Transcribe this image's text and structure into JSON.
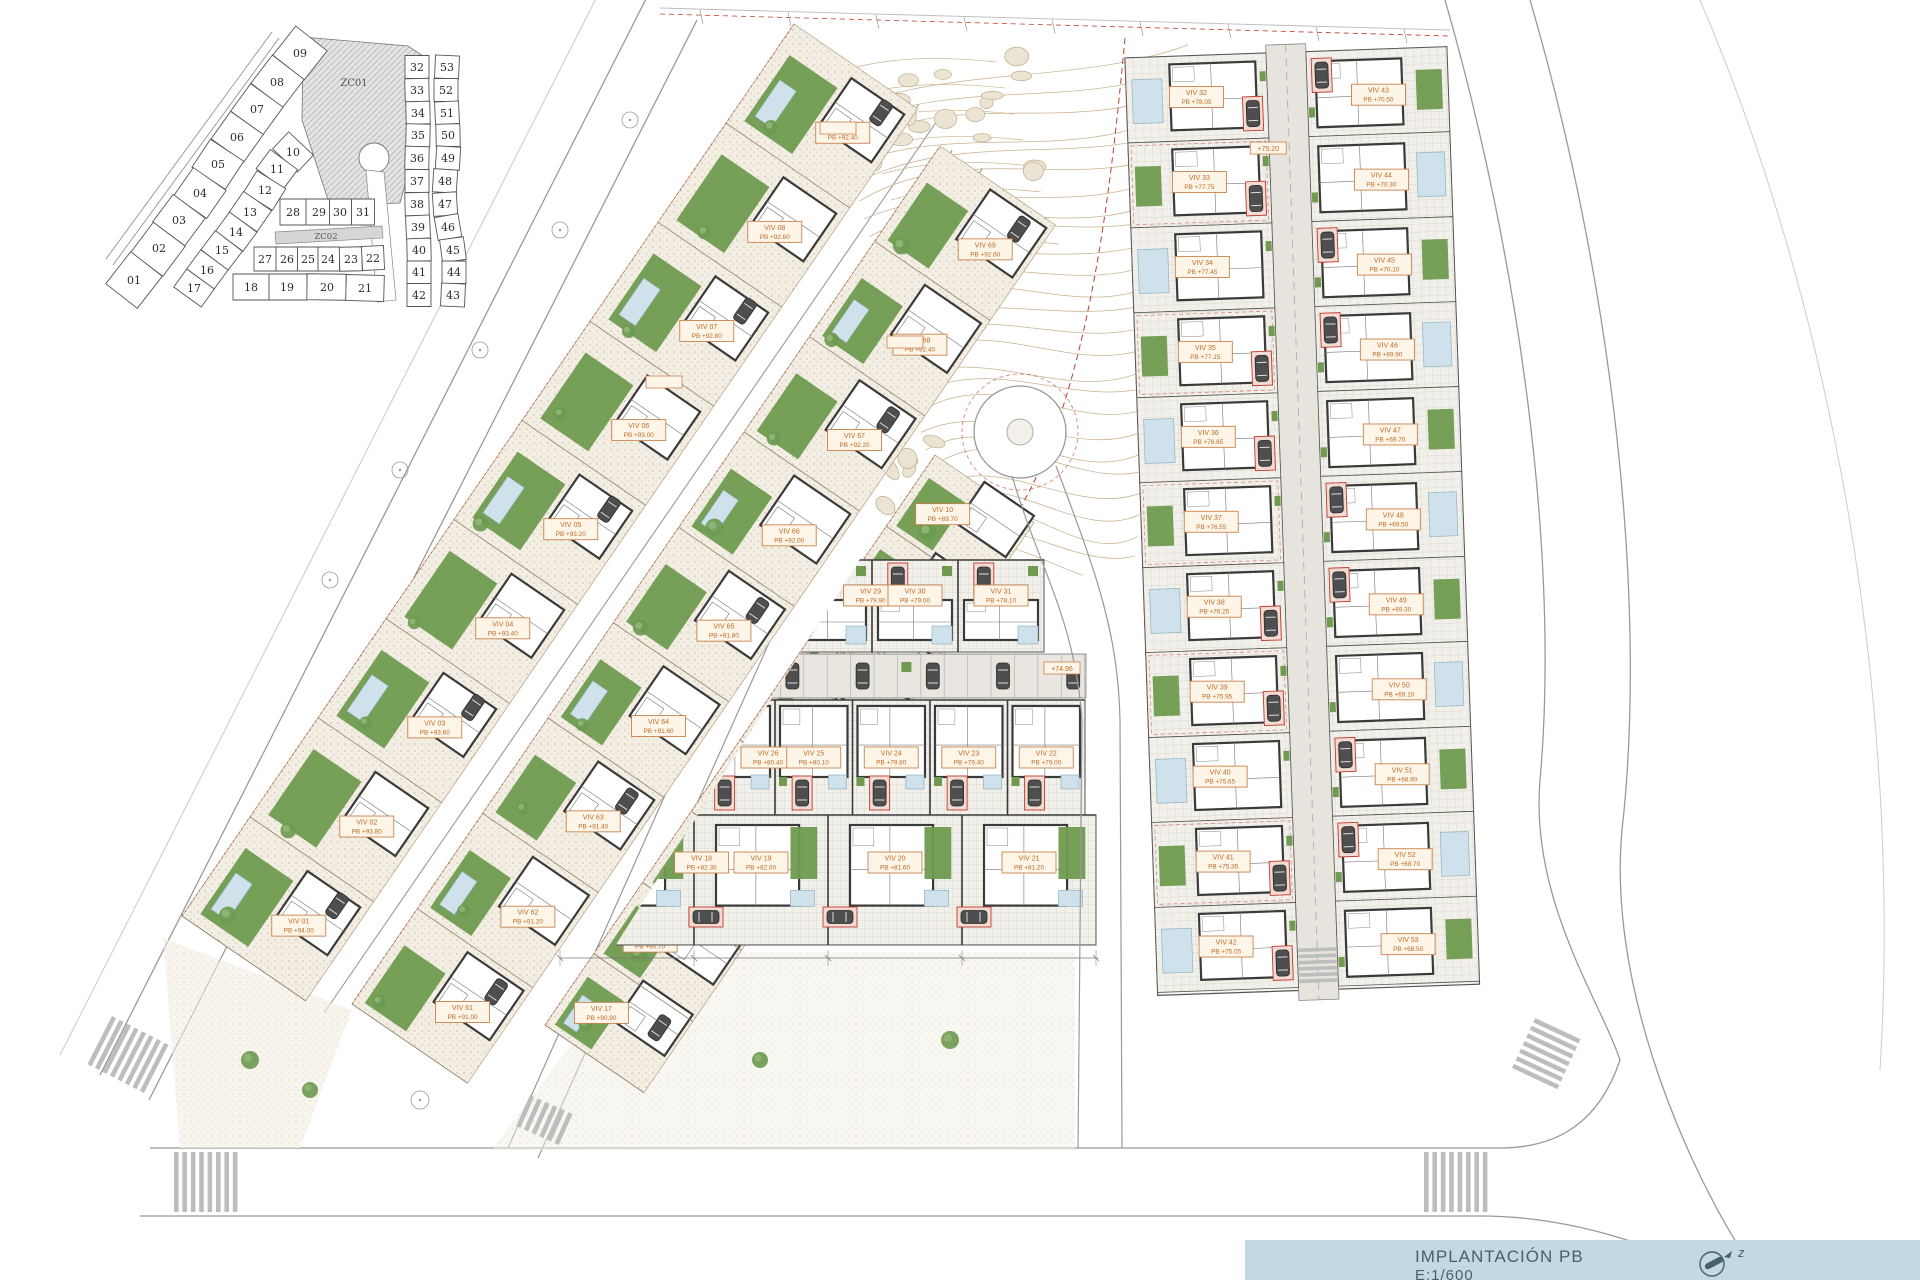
{
  "title_block": {
    "title": "IMPLANTACIÓN PB",
    "scale": "E:1/600",
    "north_label": "z"
  },
  "colors": {
    "label_text": "#c06a28",
    "label_bg": "#fdf5e7",
    "label_border": "#c8834f",
    "wall": "#3a3a3a",
    "garden": "#6f9a4f",
    "pool": "#cfe1ea",
    "contour": "#c8b28c",
    "road": "#999999",
    "red": "#c0392b",
    "title_bg": "#c3d8e0",
    "title_text": "#44616e"
  },
  "keyplan": {
    "zone1": "ZC01",
    "zone2": "ZC02",
    "strip_a": [
      "09",
      "08",
      "07",
      "06",
      "05",
      "04",
      "03",
      "02",
      "01"
    ],
    "strip_inner": [
      "10",
      "11",
      "12",
      "13",
      "14",
      "15",
      "16",
      "17"
    ],
    "row_top": [
      "28",
      "29",
      "30",
      "31"
    ],
    "row_mid": [
      "27",
      "26",
      "25",
      "24",
      "23",
      "22"
    ],
    "row_bottom": [
      "18",
      "19",
      "20",
      "21"
    ],
    "right_left_col": [
      "32",
      "33",
      "34",
      "35",
      "36",
      "37",
      "38",
      "39",
      "40",
      "41",
      "42"
    ],
    "right_right_col": [
      "53",
      "52",
      "51",
      "50",
      "49",
      "48",
      "47",
      "46",
      "45",
      "44",
      "43"
    ]
  },
  "site": {
    "strip_a_villas": [
      {
        "name": "VIV 01",
        "elev": "PB +94.00"
      },
      {
        "name": "VIV 02",
        "elev": "PB +93.80"
      },
      {
        "name": "VIV 03",
        "elev": "PB +93.60"
      },
      {
        "name": "VIV 04",
        "elev": "PB +93.40"
      },
      {
        "name": "VIV 05",
        "elev": "PB +93.20"
      },
      {
        "name": "VIV 06",
        "elev": "PB +93.00"
      },
      {
        "name": "VIV 07",
        "elev": "PB +92.80"
      },
      {
        "name": "VIV 08",
        "elev": "PB +92.60"
      },
      {
        "name": "VIV 09",
        "elev": "PB +92.40"
      }
    ],
    "strip_b_villas": [
      {
        "name": "VIV 61",
        "elev": "PB +91.00"
      },
      {
        "name": "VIV 62",
        "elev": "PB +91.20"
      },
      {
        "name": "VIV 63",
        "elev": "PB +91.40"
      },
      {
        "name": "VIV 64",
        "elev": "PB +91.60"
      },
      {
        "name": "VIV 65",
        "elev": "PB +91.80"
      },
      {
        "name": "VIV 66",
        "elev": "PB +92.00"
      },
      {
        "name": "VIV 67",
        "elev": "PB +92.20"
      },
      {
        "name": "VIV 68",
        "elev": "PB +92.40"
      },
      {
        "name": "VIV 69",
        "elev": "PB +92.60"
      }
    ],
    "strip_c_villas": [
      {
        "name": "VIV 17",
        "elev": "PB +90.90"
      },
      {
        "name": "VIV 16",
        "elev": "PB +90.70"
      },
      {
        "name": "VIV 15",
        "elev": "PB +90.50"
      },
      {
        "name": "VIV 14",
        "elev": "PB +90.30"
      },
      {
        "name": "VIV 13",
        "elev": "PB +90.10"
      },
      {
        "name": "VIV 12",
        "elev": "PB +90.10"
      },
      {
        "name": "VIV 11",
        "elev": "PB +89.90"
      },
      {
        "name": "VIV 10",
        "elev": "PB +89.70"
      }
    ],
    "row_top_villas": [
      {
        "name": "VIV 28",
        "elev": "PB +81.00"
      },
      {
        "name": "VIV 29",
        "elev": "PB +79.90"
      },
      {
        "name": "VIV 30",
        "elev": "PB +79.00"
      },
      {
        "name": "VIV 31",
        "elev": "PB +78.10"
      }
    ],
    "row_mid_villas": [
      {
        "name": "VIV 27",
        "elev": "PB +80.70"
      },
      {
        "name": "VIV 26",
        "elev": "PB +80.40"
      },
      {
        "name": "VIV 25",
        "elev": "PB +80.10"
      },
      {
        "name": "VIV 24",
        "elev": "PB +79.80"
      },
      {
        "name": "VIV 23",
        "elev": "PB +79.40"
      },
      {
        "name": "VIV 22",
        "elev": "PB +79.00"
      }
    ],
    "row_bottom_villas": [
      {
        "name": "VIV 18",
        "elev": "PB +82.30"
      },
      {
        "name": "VIV 19",
        "elev": "PB +82.00"
      },
      {
        "name": "VIV 20",
        "elev": "PB +81.60"
      },
      {
        "name": "VIV 21",
        "elev": "PB +81.20"
      }
    ],
    "right_left_col_villas": [
      {
        "name": "VIV 32",
        "elev": "PB +78.05"
      },
      {
        "name": "VIV 33",
        "elev": "PB +77.75"
      },
      {
        "name": "VIV 34",
        "elev": "PB +77.45"
      },
      {
        "name": "VIV 35",
        "elev": "PB +77.15"
      },
      {
        "name": "VIV 36",
        "elev": "PB +76.85"
      },
      {
        "name": "VIV 37",
        "elev": "PB +76.55"
      },
      {
        "name": "VIV 38",
        "elev": "PB +76.25"
      },
      {
        "name": "VIV 39",
        "elev": "PB +75.95"
      },
      {
        "name": "VIV 40",
        "elev": "PB +75.65"
      },
      {
        "name": "VIV 41",
        "elev": "PB +75.35"
      },
      {
        "name": "VIV 42",
        "elev": "PB +75.05"
      }
    ],
    "right_right_col_villas": [
      {
        "name": "VIV 43",
        "elev": "PB +70.50"
      },
      {
        "name": "VIV 44",
        "elev": "PB +70.30"
      },
      {
        "name": "VIV 45",
        "elev": "PB +70.10"
      },
      {
        "name": "VIV 46",
        "elev": "PB +69.90"
      },
      {
        "name": "VIV 47",
        "elev": "PB +69.70"
      },
      {
        "name": "VIV 48",
        "elev": "PB +69.50"
      },
      {
        "name": "VIV 49",
        "elev": "PB +69.30"
      },
      {
        "name": "VIV 50",
        "elev": "PB +69.10"
      },
      {
        "name": "VIV 51",
        "elev": "PB +68.90"
      },
      {
        "name": "VIV 52",
        "elev": "PB +68.70"
      },
      {
        "name": "VIV 53",
        "elev": "PB +68.50"
      }
    ],
    "road_markers": [
      {
        "text": "+75.20"
      },
      {
        "text": "+74.96"
      }
    ]
  }
}
